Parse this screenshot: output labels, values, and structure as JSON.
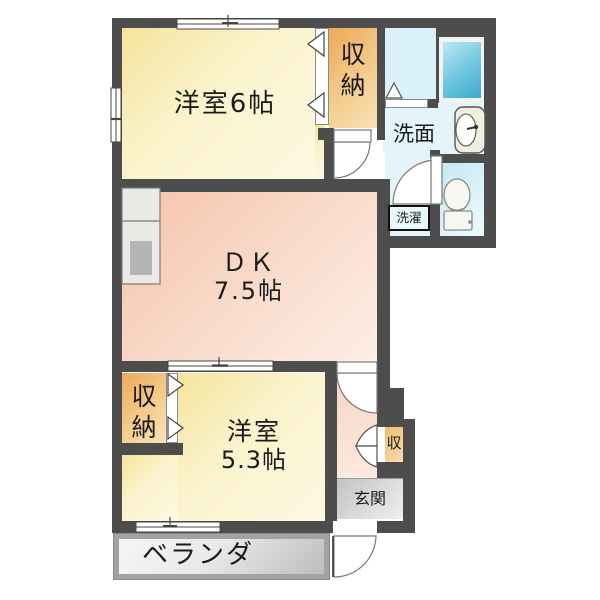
{
  "plan": {
    "type": "apartment-floor-plan",
    "rooms": {
      "bedroom6": {
        "label": "洋室6帖"
      },
      "storage_upper": {
        "label": "収納"
      },
      "washroom": {
        "label": "洗面"
      },
      "laundry": {
        "label": "洗濯"
      },
      "dk": {
        "name": "ＤＫ",
        "size": "7.5帖"
      },
      "bedroom53": {
        "name": "洋室",
        "size": "5.3帖"
      },
      "storage_lower": {
        "label": "収納"
      },
      "storage_entry": {
        "label": "収"
      },
      "entrance": {
        "label": "玄関"
      },
      "veranda": {
        "label": "ベランダ"
      }
    },
    "fixtures": [
      "bathtub",
      "washbasin",
      "toilet",
      "kitchen-counter",
      "laundry-space"
    ],
    "colors": {
      "wall": "#4d4d4d",
      "western_room": "#faf0bc",
      "closet": "#f2bc72",
      "dk": "#f8cfba",
      "bathroom": "#daf1f9",
      "toilet_room": "#cdecf5",
      "bathtub": "#45b5d4",
      "genkan": "#d9d9d9",
      "veranda": "#d4d4d4"
    }
  }
}
